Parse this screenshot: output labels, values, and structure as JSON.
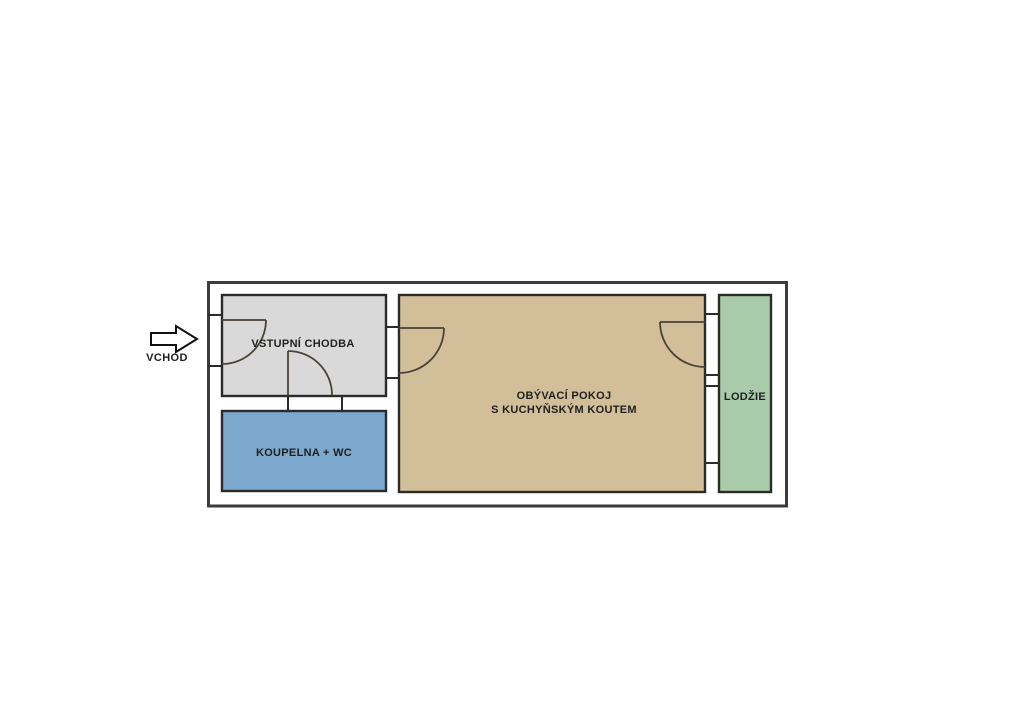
{
  "plan": {
    "type": "apartment-floor-plan",
    "background": "#ffffff"
  },
  "entrance": {
    "label": "VCHOD"
  },
  "rooms": {
    "hall": {
      "label": "VSTUPNÍ CHODBA",
      "color": "#d9d9d9"
    },
    "bathroom": {
      "label": "KOUPELNA + WC",
      "color": "#7da8cd"
    },
    "living": {
      "label_line1": "OBÝVACÍ POKOJ",
      "label_line2": "S KUCHYŇSKÝM KOUTEM",
      "color": "#d2bf99"
    },
    "loggia": {
      "label": "LODŽIE",
      "color": "#a9cba9"
    }
  },
  "colors": {
    "outer_wall": "#3c3c3c",
    "room_border": "#2b2b2b",
    "door_line": "#4a4238",
    "text": "#1f1f1f",
    "arrow_fill": "#ffffff",
    "arrow_stroke": "#111111"
  }
}
